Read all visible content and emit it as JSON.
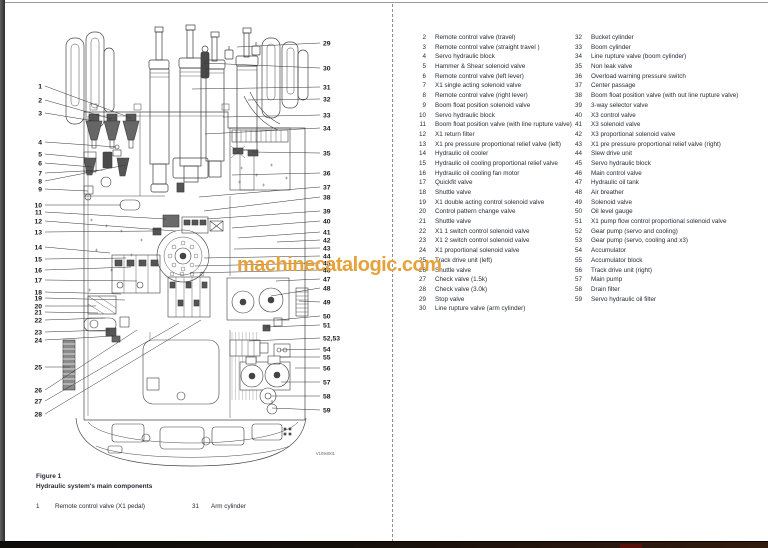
{
  "page": {
    "watermark": "machinecatalogic.com",
    "watermark_color": "#E5A23A",
    "figure_code": "V1094001"
  },
  "caption": {
    "figure_label": "Figure 1",
    "figure_title": "Hydraulic system's main components",
    "footnote": [
      {
        "num": "1",
        "label": "Remote control valve (X1 pedal)"
      },
      {
        "num": "31",
        "label": "Arm cylinder"
      }
    ]
  },
  "parts_list": {
    "left": [
      {
        "num": "2",
        "label": "Remote control valve (travel)"
      },
      {
        "num": "3",
        "label": "Remote control valve (straight travel )"
      },
      {
        "num": "4",
        "label": "Servo hydraulic block"
      },
      {
        "num": "5",
        "label": "Hammer & Shear solenoid valve"
      },
      {
        "num": "6",
        "label": "Remote control valve (left lever)"
      },
      {
        "num": "7",
        "label": "X1 single acting solenoid valve"
      },
      {
        "num": "8",
        "label": "Remote control valve (right lever)"
      },
      {
        "num": "9",
        "label": "Boom float position solenoid valve"
      },
      {
        "num": "10",
        "label": "Servo hydraulic block"
      },
      {
        "num": "11",
        "label": "Boom float position valve (with line rupture valve)"
      },
      {
        "num": "12",
        "label": "X1 return filter"
      },
      {
        "num": "13",
        "label": "X1 pre pressure proportional relief valve (left)"
      },
      {
        "num": "14",
        "label": "Hydraulic oil cooler"
      },
      {
        "num": "15",
        "label": "Hydraulic oil cooling proportional relief valve"
      },
      {
        "num": "16",
        "label": "Hydraulic oil cooling fan motor"
      },
      {
        "num": "17",
        "label": "Quickfit valve"
      },
      {
        "num": "18",
        "label": "Shuttle valve"
      },
      {
        "num": "19",
        "label": "X1 double acting control solenoid valve"
      },
      {
        "num": "20",
        "label": "Control pattern change valve"
      },
      {
        "num": "21",
        "label": "Shuttle valve"
      },
      {
        "num": "22",
        "label": "X1 1 switch control solenoid valve"
      },
      {
        "num": "23",
        "label": "X1 2 switch control solenoid valve"
      },
      {
        "num": "24",
        "label": "X1 proportional solenoid valve"
      },
      {
        "num": "25",
        "label": "Track drive unit (left)"
      },
      {
        "num": "26",
        "label": "Shuttle valve"
      },
      {
        "num": "27",
        "label": "Check valve (1.5k)"
      },
      {
        "num": "28",
        "label": "Check valve (3.0k)"
      },
      {
        "num": "29",
        "label": "Stop valve"
      },
      {
        "num": "30",
        "label": "Line rupture valve (arm cylinder)"
      }
    ],
    "right": [
      {
        "num": "32",
        "label": "Bucket cylinder"
      },
      {
        "num": "33",
        "label": "Boom cylinder"
      },
      {
        "num": "34",
        "label": "Line rupture valve (boom cylinder)"
      },
      {
        "num": "35",
        "label": "Non leak valve"
      },
      {
        "num": "36",
        "label": "Overload warning pressure switch"
      },
      {
        "num": "37",
        "label": "Center passage"
      },
      {
        "num": "38",
        "label": "Boom float position valve (with out line rupture valve)"
      },
      {
        "num": "39",
        "label": "3-way selector valve"
      },
      {
        "num": "40",
        "label": "X3 control valve"
      },
      {
        "num": "41",
        "label": "X3 solenoid valve"
      },
      {
        "num": "42",
        "label": "X3 proportional solenoid valve"
      },
      {
        "num": "43",
        "label": "X1 pre pressure proportional relief valve (right)"
      },
      {
        "num": "44",
        "label": "Slew drive unit"
      },
      {
        "num": "45",
        "label": "Servo hydraulic block"
      },
      {
        "num": "46",
        "label": "Main control valve"
      },
      {
        "num": "47",
        "label": "Hydraulic oil tank"
      },
      {
        "num": "48",
        "label": "Air breather"
      },
      {
        "num": "49",
        "label": "Solenoid valve"
      },
      {
        "num": "50",
        "label": "Oil level gauge"
      },
      {
        "num": "51",
        "label": "X1 pump flow control proportional solenoid valve"
      },
      {
        "num": "52",
        "label": "Gear pump (servo and cooling)"
      },
      {
        "num": "53",
        "label": "Gear pump (servo, cooling and x3)"
      },
      {
        "num": "54",
        "label": "Accumulator"
      },
      {
        "num": "55",
        "label": "Accumulator block"
      },
      {
        "num": "56",
        "label": "Track drive unit (right)"
      },
      {
        "num": "57",
        "label": "Main pump"
      },
      {
        "num": "58",
        "label": "Drain filter"
      },
      {
        "num": "59",
        "label": "Servo hydraulic oil filter"
      }
    ]
  },
  "diagram": {
    "callouts_left": [
      "1",
      "2",
      "3",
      "4",
      "5",
      "6",
      "7",
      "8",
      "9",
      "10",
      "11",
      "12",
      "13",
      "14",
      "15",
      "16",
      "17",
      "18",
      "19",
      "20",
      "21",
      "22",
      "23",
      "24",
      "25",
      "26",
      "27",
      "28"
    ],
    "callouts_right": [
      "29",
      "30",
      "31",
      "32",
      "33",
      "34",
      "35",
      "36",
      "37",
      "38",
      "39",
      "40",
      "41",
      "42",
      "43",
      "44",
      "45",
      "46",
      "47",
      "48",
      "49",
      "50",
      "51",
      "52,53",
      "54",
      "55",
      "56",
      "57",
      "58",
      "59"
    ]
  }
}
